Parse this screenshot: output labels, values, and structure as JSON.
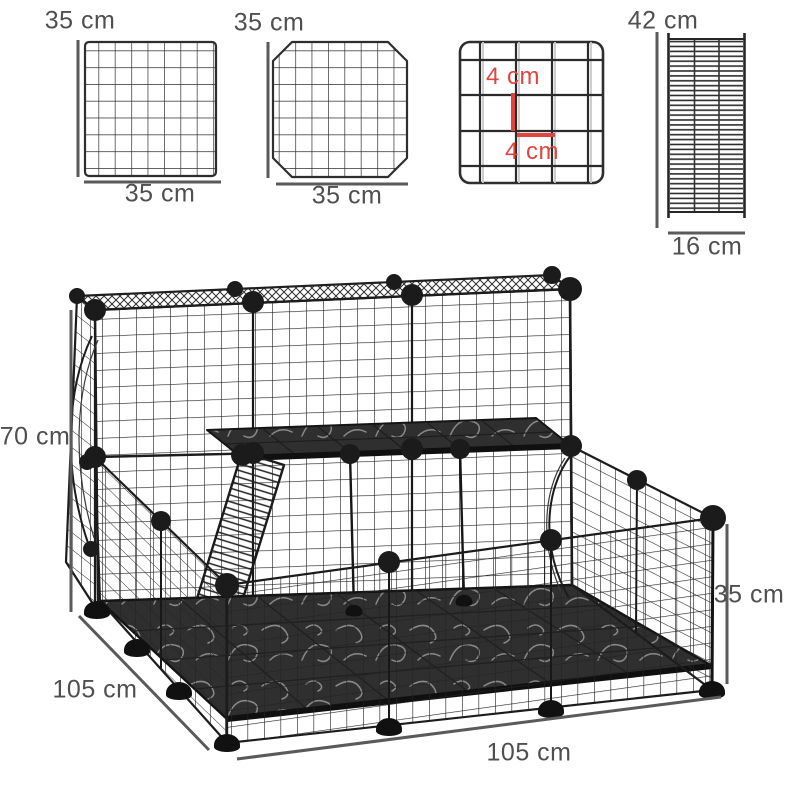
{
  "panels": {
    "square_panel": {
      "width_top": "35 cm",
      "width_bottom": "35 cm"
    },
    "door_panel": {
      "width_top": "35 cm",
      "width_bottom": "35 cm"
    },
    "mesh_detail": {
      "cell_height": "4 cm",
      "cell_width": "4 cm"
    },
    "ramp_panel": {
      "height": "42 cm",
      "width": "16 cm"
    }
  },
  "cage": {
    "height": "70 cm",
    "depth": "105 cm",
    "width": "105 cm",
    "fence_height": "35 cm"
  },
  "colors": {
    "label_gray": "#4f4f4f",
    "dimension_line_gray": "#5a5a5a",
    "accent_red": "#e04540",
    "wire_black": "#1c1c1c"
  }
}
